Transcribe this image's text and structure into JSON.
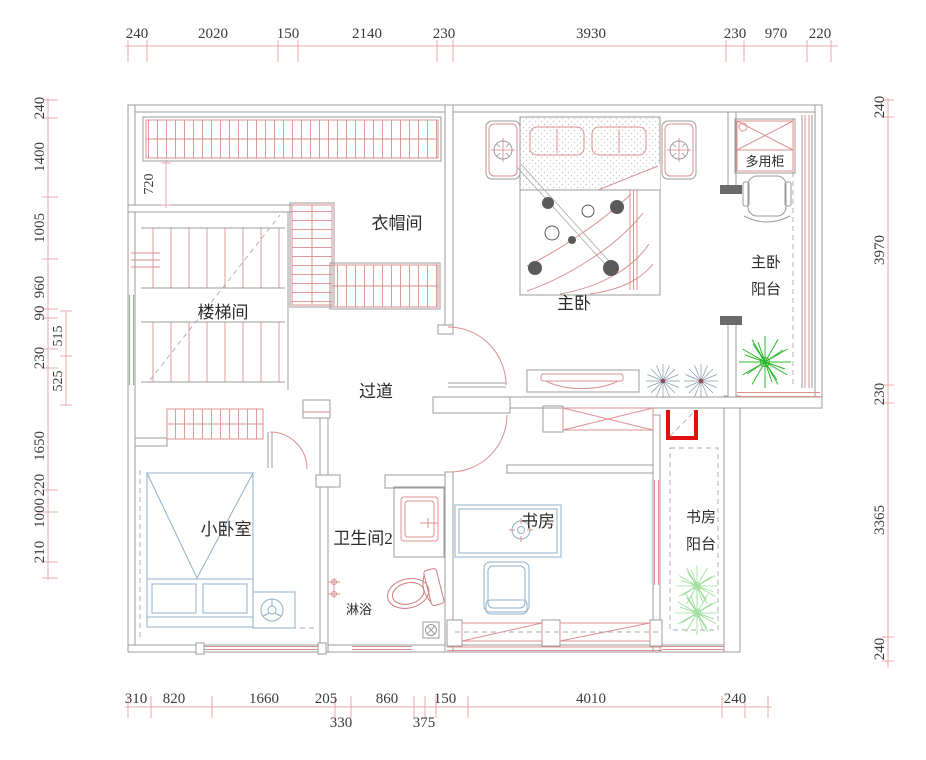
{
  "drawing": {
    "type": "residential floor plan",
    "rooms": {
      "cloakroom": "衣帽间",
      "staircase": "楼梯间",
      "master_bedroom": "主卧",
      "corridor": "过道",
      "small_bedroom": "小卧室",
      "bathroom2": "卫生间2",
      "shower": "淋浴",
      "study": "书房",
      "multi_cabinet": "多用柜",
      "master_balcony": [
        "主卧",
        "阳台"
      ],
      "study_balcony": [
        "书房",
        "阳台"
      ]
    },
    "dims": {
      "top": [
        "240",
        "2020",
        "150",
        "2140",
        "230",
        "3930",
        "230",
        "970",
        "220"
      ],
      "bottom_row1": [
        "310",
        "820",
        "1660",
        "205",
        "860",
        "150",
        "4010",
        "240"
      ],
      "bottom_row2": [
        "330",
        "375"
      ],
      "left_outer": [
        "240",
        "1400",
        "1005",
        "960",
        "90",
        "230",
        "1650",
        "220",
        "1000",
        "210"
      ],
      "left_inner": [
        "515",
        "525"
      ],
      "right": [
        "240",
        "3970",
        "230",
        "3365",
        "240"
      ],
      "closet_depth": "720"
    },
    "colors": {
      "wall_gray": "#9b9b9b",
      "furniture_red": "#dd8f8f",
      "dimension_red": "#e8a8a8",
      "furniture_blue": "#8fb0c9",
      "plant_green": "#2db82d",
      "plant_light_green": "#9ade9a",
      "highlight_red": "#e01010",
      "text": "#2b2b2b"
    }
  }
}
